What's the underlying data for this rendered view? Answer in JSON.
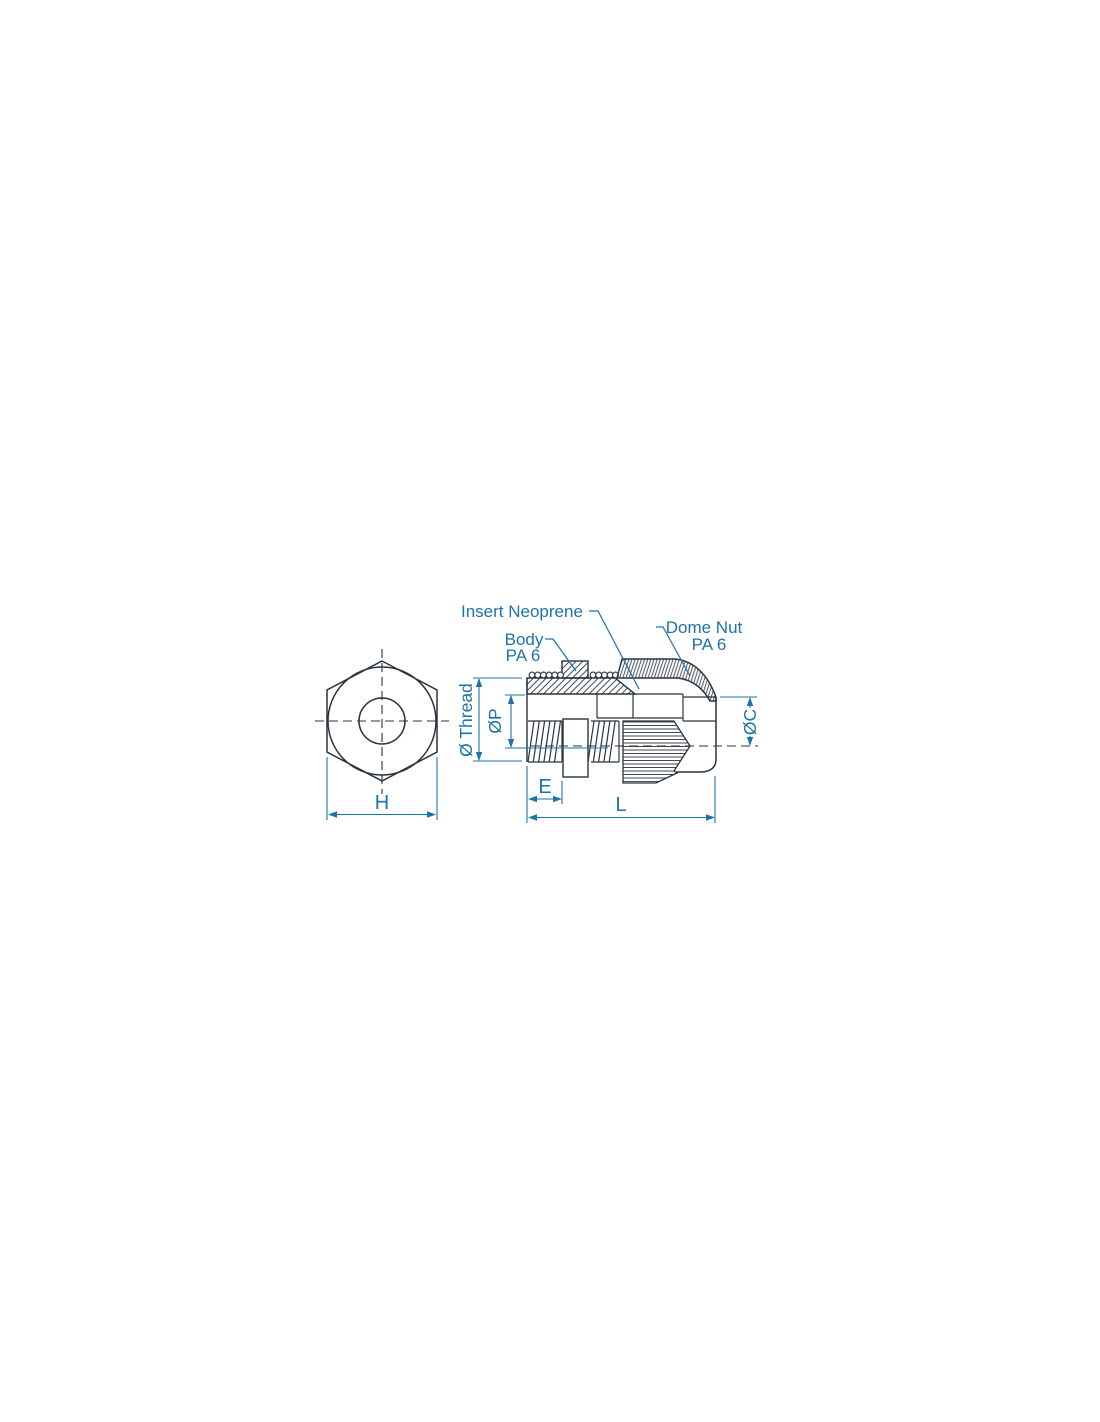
{
  "drawing": {
    "part_labels": {
      "insert": "Insert Neoprene",
      "body_line1": "Body",
      "body_line2": "PA 6",
      "dome_nut_line1": "Dome Nut",
      "dome_nut_line2": "PA 6"
    },
    "dimensions": {
      "across_flats": "H",
      "thread_length": "E",
      "total_length": "L",
      "thread_diameter": "Ø Thread",
      "bore_diameter": "ØP",
      "dome_diameter": "ØC"
    },
    "colors": {
      "outline": "#2a3440",
      "dimension_accent": "#1e73ab",
      "background": "#ffffff"
    }
  }
}
